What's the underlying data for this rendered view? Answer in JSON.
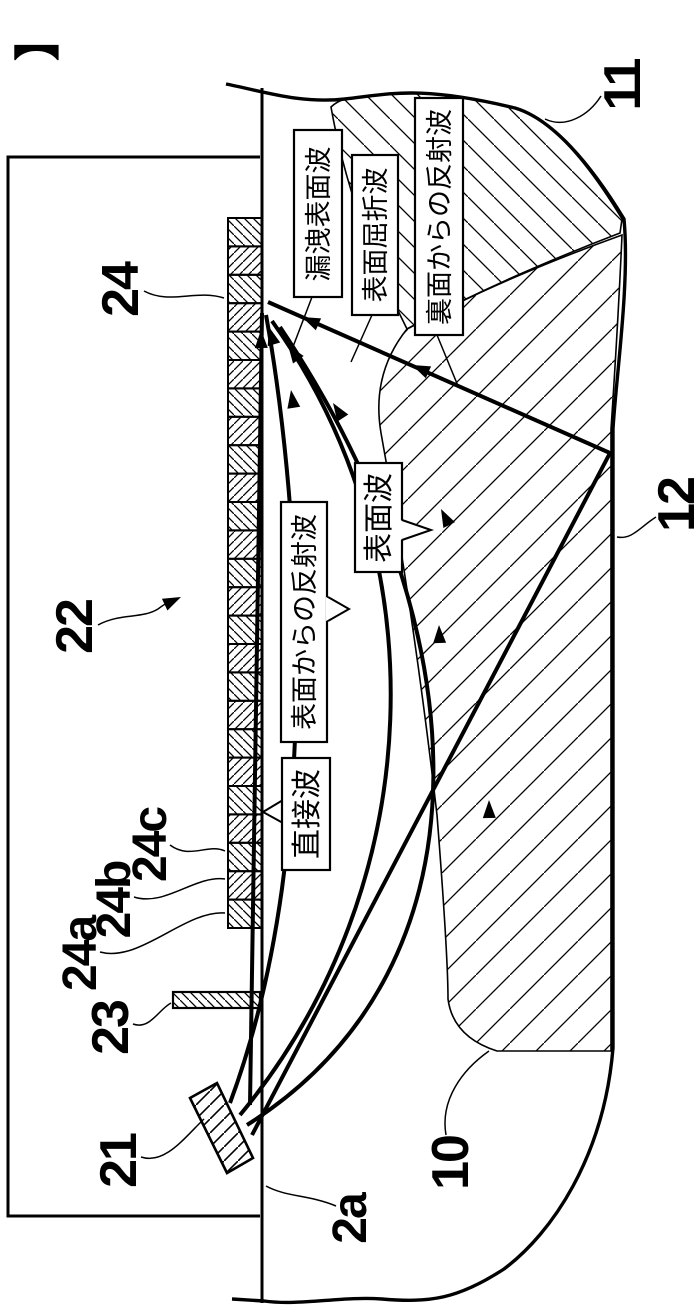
{
  "figure": {
    "marker": "】",
    "wave_labels": {
      "leaky_surface": "漏洩表面波",
      "surface_refraction": "表面屈折波",
      "back_reflection": "裏面からの反射波",
      "surface_wave": "表面波",
      "surface_reflection": "表面からの反射波",
      "direct_wave": "直接波"
    },
    "reference_labels": {
      "n11": "11",
      "n12": "12",
      "n22": "22",
      "n24": "24",
      "n24a": "24a",
      "n24b": "24b",
      "n24c": "24c",
      "n23": "23",
      "n21": "21",
      "n10": "10",
      "n2a": "2a"
    },
    "colors": {
      "ink": "#000000",
      "paper": "#ffffff"
    }
  }
}
